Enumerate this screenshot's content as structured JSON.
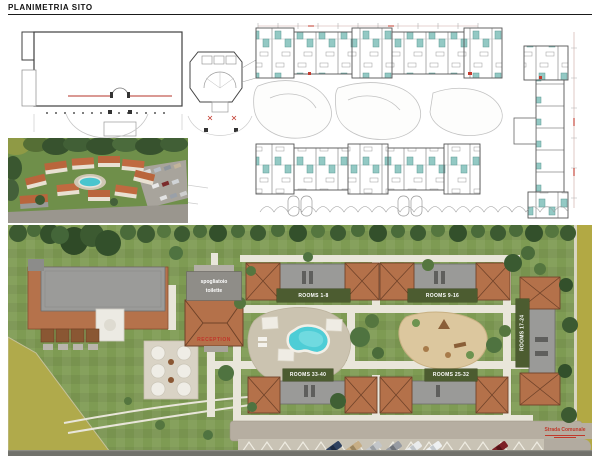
{
  "title": "PLANIMETRIA SITO",
  "site_plan": {
    "buildings": {
      "rooms_1_8": "ROOMS 1-8",
      "rooms_9_16": "ROOMS 9-16",
      "rooms_17_24": "ROOMS 17-24",
      "rooms_25_32": "ROOMS 25-32",
      "rooms_33_40": "ROOMS 33-40"
    },
    "reception": {
      "line1": "spogliatoio",
      "line2": "toilette",
      "name": "RECEPTION"
    },
    "road_label": "Strada Comunale"
  },
  "colors": {
    "accent_red": "#c0392b",
    "label_band_green": "#4c5c30",
    "grass_green": "#7e9b53",
    "roof_terracotta": "#b4714a",
    "flat_roof_gray": "#9a9a98",
    "pool_water": "#4ecdd6",
    "road_olive": "#b2a944",
    "sand": "#dcc79e",
    "bathroom_teal": "#93c9c4"
  }
}
